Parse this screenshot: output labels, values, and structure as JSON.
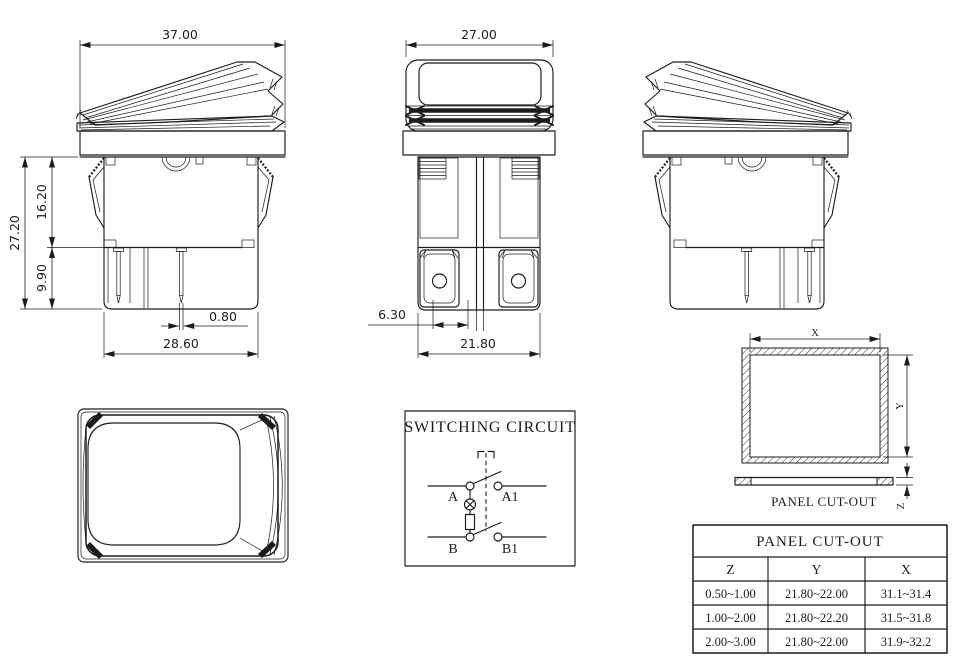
{
  "drawing": {
    "side_view": {
      "dim_width_top": "37.00",
      "dim_height_total": "27.20",
      "dim_height_upper": "16.20",
      "dim_height_lower": "9.90",
      "dim_pin_thickness": "0.80",
      "dim_width_bottom": "28.60"
    },
    "front_view": {
      "dim_width_top": "27.00",
      "dim_terminal_spacing": "6.30",
      "dim_width_bottom": "21.80"
    },
    "circuit": {
      "title": "SWITCHING CIRCUIT",
      "terminal_a": "A",
      "terminal_a1": "A1",
      "terminal_b": "B",
      "terminal_b1": "B1"
    },
    "panel_cutout": {
      "caption": "PANEL CUT-OUT",
      "dim_x": "X",
      "dim_y": "Y",
      "dim_z": "Z"
    }
  },
  "table": {
    "title": "PANEL CUT-OUT",
    "columns": [
      "Z",
      "Y",
      "X"
    ],
    "rows": [
      [
        "0.50~1.00",
        "21.80~22.00",
        "31.1~31.4"
      ],
      [
        "1.00~2.00",
        "21.80~22.20",
        "31.5~31.8"
      ],
      [
        "2.00~3.00",
        "21.80~22.00",
        "31.9~32.2"
      ]
    ]
  },
  "colors": {
    "line": "#1c1c1c",
    "background": "#ffffff"
  }
}
